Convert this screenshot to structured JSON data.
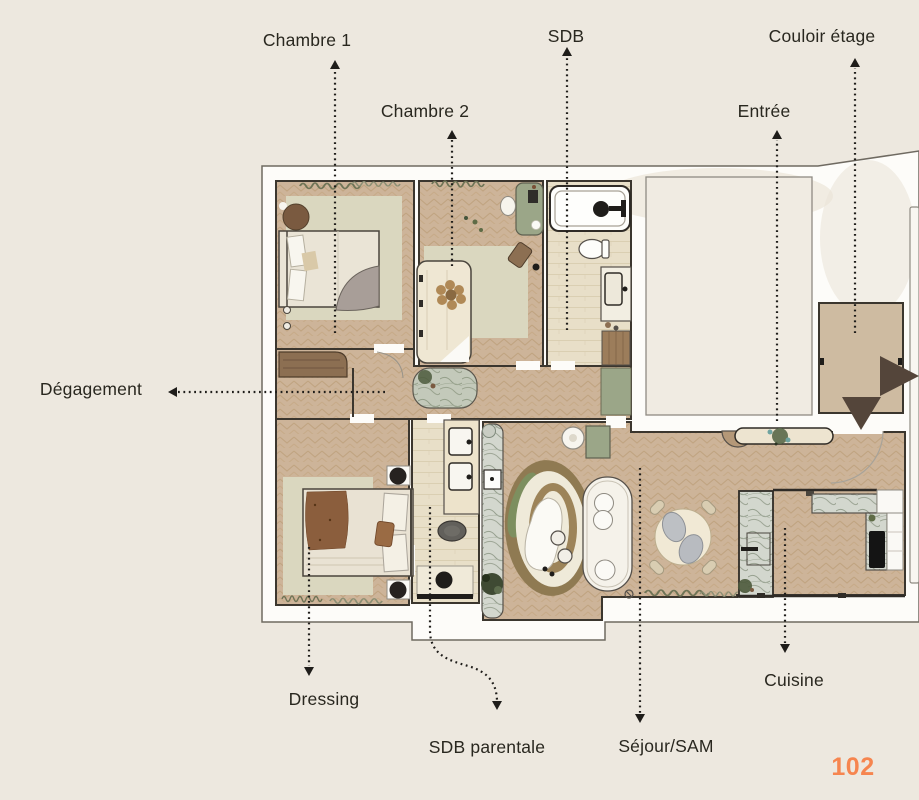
{
  "page": {
    "number": "102",
    "background": "#EDE8DF"
  },
  "colors": {
    "bg": "#EDE8DF",
    "accent": "#F6854F",
    "label_text": "#29271F",
    "wall": "#3B362E",
    "plan_white": "#FDFCF9",
    "floor_tan": "#CDB499",
    "floor_stone": "#E8DFC8",
    "rug_sage": "#DAD7BF",
    "green_furniture": "#9BA688",
    "marble": "#D3D7CE",
    "wood_dark": "#8C6F52",
    "entry_arrow_brown": "#54453A",
    "leader_line": "#1F1D1A"
  },
  "labels": {
    "chambre1": "Chambre 1",
    "chambre2": "Chambre 2",
    "sdb": "SDB",
    "couloir_etage": "Couloir étage",
    "entree": "Entrée",
    "degagement": "Dégagement",
    "dressing": "Dressing",
    "sdb_parentale": "SDB parentale",
    "sejour_sam": "Séjour/SAM",
    "cuisine": "Cuisine"
  }
}
